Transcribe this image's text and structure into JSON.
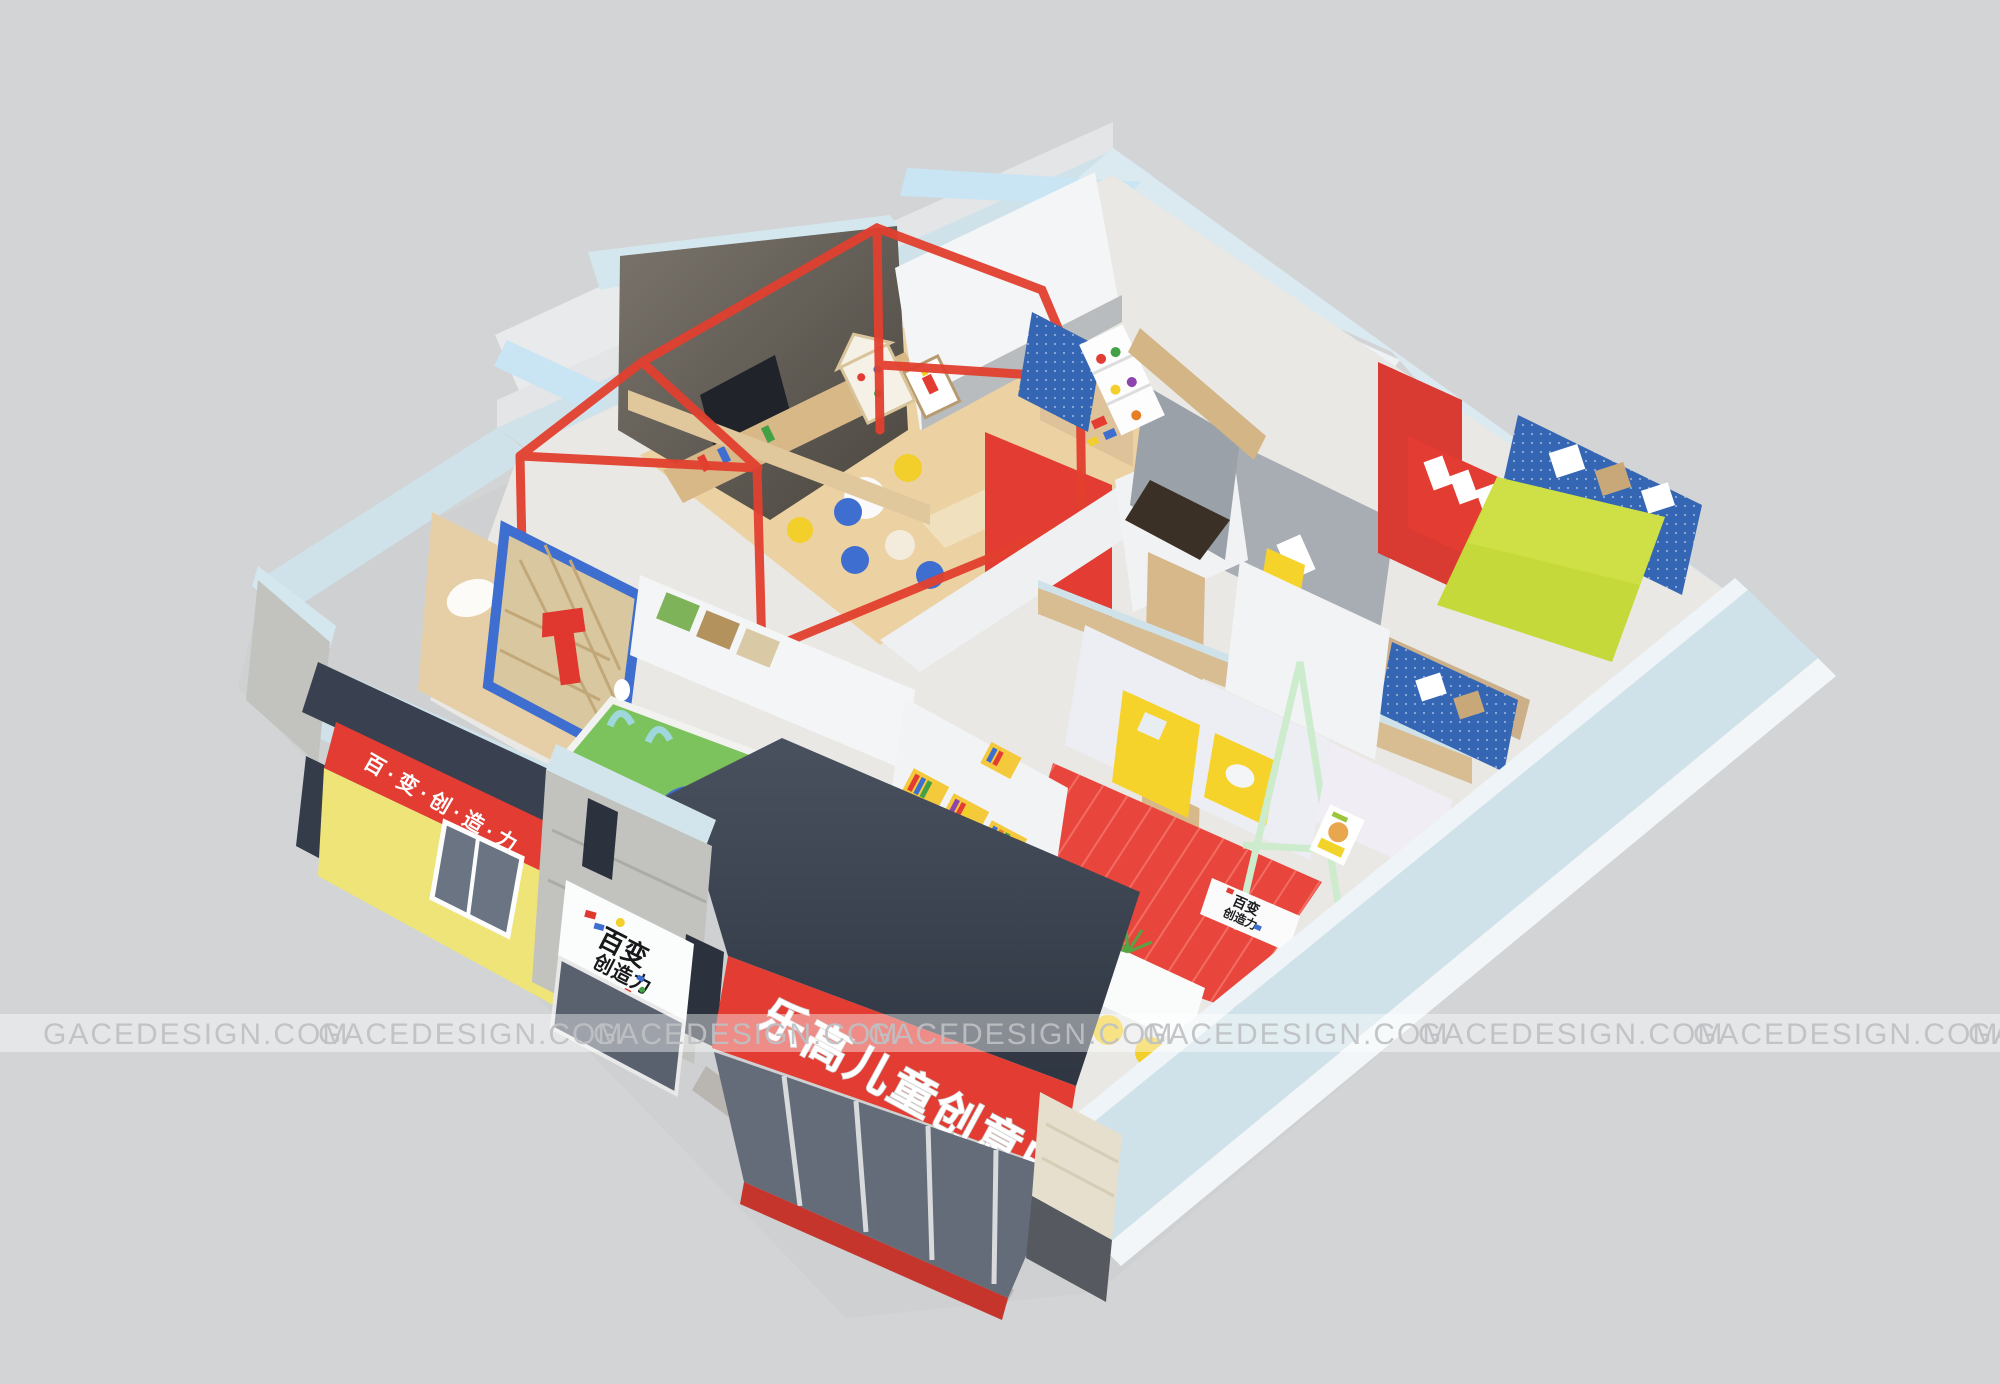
{
  "watermark": {
    "text": "GACEDESIGN.COM"
  },
  "signs": {
    "main_sign": "乐高儿童创意中心",
    "side_sign": "百·变·创·造·力",
    "logo_line1": "百变",
    "logo_line2": "创造力",
    "reception_line1": "百变",
    "reception_line2": "创造力"
  },
  "colors": {
    "background": "#d2d4d6",
    "watermark_text": "#bfc1c4",
    "brand_red": "#e23c33",
    "door_yellow": "#f6d32b",
    "storefront_yellow": "#efe478",
    "brand_blue": "#3566b4",
    "chair_blue": "#3e6ed0",
    "lime_green": "#c6d93a",
    "turf_green": "#7cc35e",
    "awning_navy": "#394150",
    "wall_cap_cyan": "#cfe2ea",
    "wood": "#d8bd92",
    "concrete": "#c2c3bf",
    "terrazzo": "#e9e8e4",
    "white_wall": "#f4f5f6",
    "media_wall_gray": "#6e6760"
  }
}
